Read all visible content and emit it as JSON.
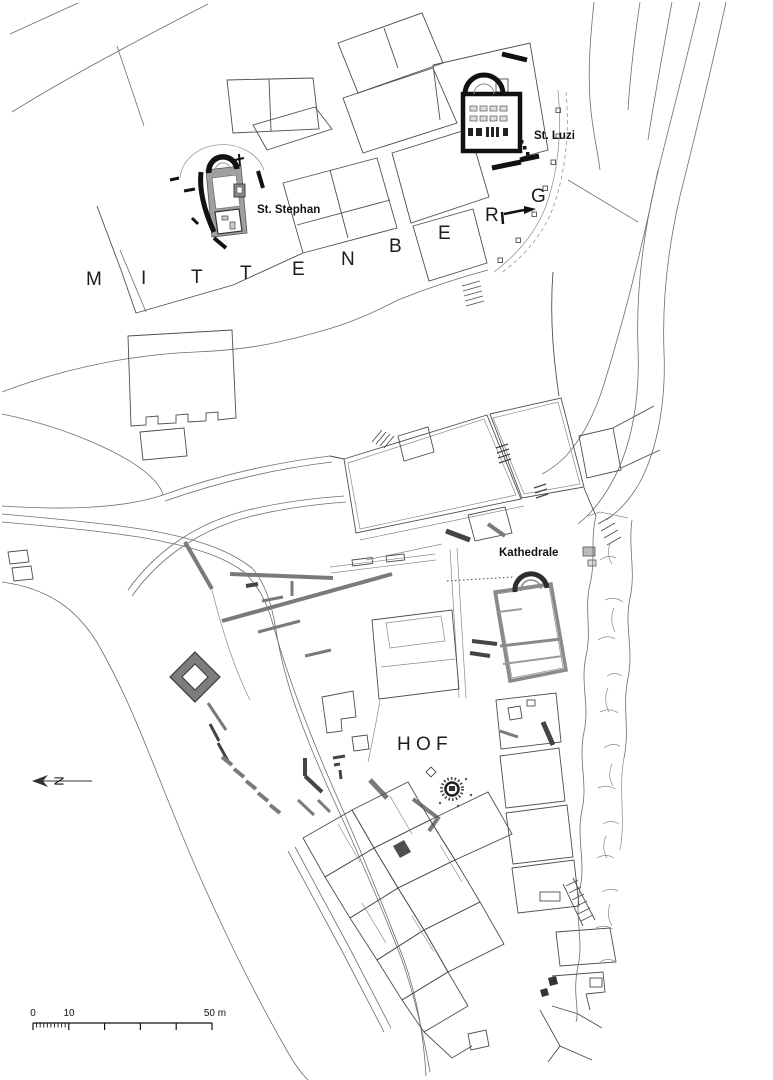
{
  "map": {
    "description": "Archaeological site plan of the Hof and Mittenberg hills with churches",
    "region_labels": {
      "mittenberg": {
        "letters": [
          "M",
          "I",
          "T",
          "T",
          "E",
          "N",
          "B",
          "E",
          "R",
          "G"
        ]
      },
      "hof": {
        "text": "H O F"
      }
    },
    "site_labels": {
      "st_luzi": "St. Luzi",
      "st_stephan": "St. Stephan",
      "kathedrale": "Kathedrale"
    },
    "north_indicator": {
      "label": "N"
    },
    "scale_bar": {
      "labels": {
        "zero": "0",
        "ten": "10",
        "fifty": "50 m"
      },
      "ticks_major_m": [
        0,
        10,
        20,
        30,
        40,
        50
      ],
      "minor_from_m": 0,
      "minor_to_m": 10,
      "minor_interval_m": 1
    },
    "colors": {
      "background": "#ffffff",
      "thin_line": "#6e6e6e",
      "building_line": "#4e4e4e",
      "excavated_wall_gray": "#7a7a7a",
      "church_black": "#111111",
      "nave_fill": "#a0a0a0",
      "tower_fill": "#7d7d7d",
      "label_color": "#1c1c1c"
    }
  }
}
